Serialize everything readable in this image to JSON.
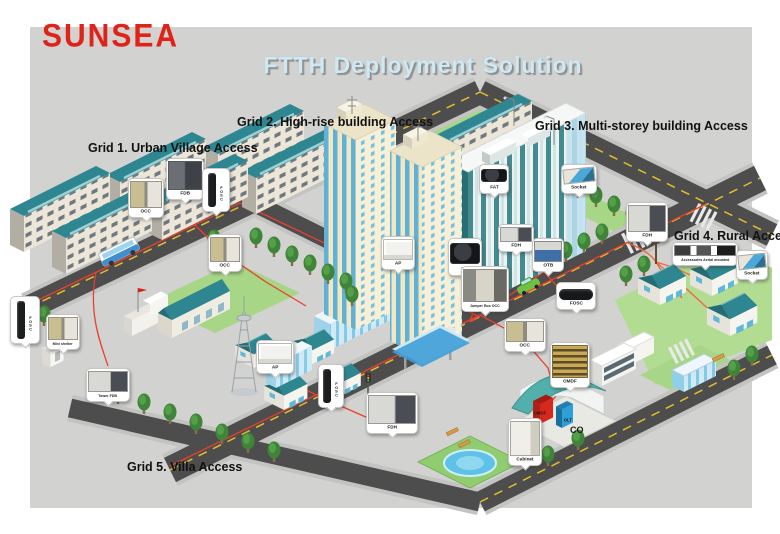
{
  "brand": {
    "logo_text": "SUNSEA",
    "logo_color": "#e02318"
  },
  "title": {
    "text": "FTTH Deployment Solution",
    "color": "#cfe8f2"
  },
  "grid_labels": [
    "Grid 1. Urban Village Access",
    "Grid 2. High-rise building Access",
    "Grid 3. Multi-storey building Access",
    "Grid 4. Rural Access",
    "Grid 5. Villa Access"
  ],
  "callouts": [
    {
      "label": "OCC",
      "location": "grid1-buildings"
    },
    {
      "label": "FDB",
      "location": "grid1-buildings"
    },
    {
      "label": "FOSC",
      "location": "grid1-pole",
      "orientation": "vertical"
    },
    {
      "label": "OCC",
      "location": "grid1-street"
    },
    {
      "label": "FOSC",
      "location": "left-road-pole",
      "orientation": "vertical"
    },
    {
      "label": "Mini shelter",
      "location": "left-area"
    },
    {
      "label": "Tower FDB",
      "location": "tv-tower"
    },
    {
      "label": "AP",
      "location": "villa-area"
    },
    {
      "label": "FOSC",
      "location": "villa-street-pole",
      "orientation": "vertical"
    },
    {
      "label": "FDH",
      "location": "villa-street"
    },
    {
      "label": "AP",
      "location": "high-rise"
    },
    {
      "label": "FAT",
      "location": "high-rise"
    },
    {
      "label": "FAT",
      "location": "multi-storey-building"
    },
    {
      "label": "Socket",
      "location": "multi-storey-building"
    },
    {
      "label": "FDH",
      "location": "multi-storey-street"
    },
    {
      "label": "OTB",
      "location": "multi-storey-street"
    },
    {
      "label": "FOSC",
      "location": "main-road"
    },
    {
      "label": "Jumper Box OCC",
      "location": "high-rise-base"
    },
    {
      "label": "OCC",
      "location": "central-office-road"
    },
    {
      "label": "OMDF",
      "location": "central-office"
    },
    {
      "label": "Cabinet",
      "location": "central-office"
    },
    {
      "label": "FDH",
      "location": "rural-area"
    },
    {
      "label": "Accessories Aerial mounted",
      "location": "rural-area"
    },
    {
      "label": "Socket",
      "location": "rural-area"
    }
  ],
  "ground_labels": {
    "omdf": "OMDF",
    "olt": "OLT",
    "co": "CO"
  },
  "colors": {
    "fiber_red": "#e8402e",
    "roof_teal": "#2e8691",
    "road": "#4d4d4d",
    "panel_bg": "#d2d2d1",
    "tower_cream": "#f1e7c4",
    "window_blue": "#45a9d8",
    "lane_yellow": "#e2bd2e",
    "logo_red": "#e02318",
    "title_blue": "#cfe8f2"
  }
}
